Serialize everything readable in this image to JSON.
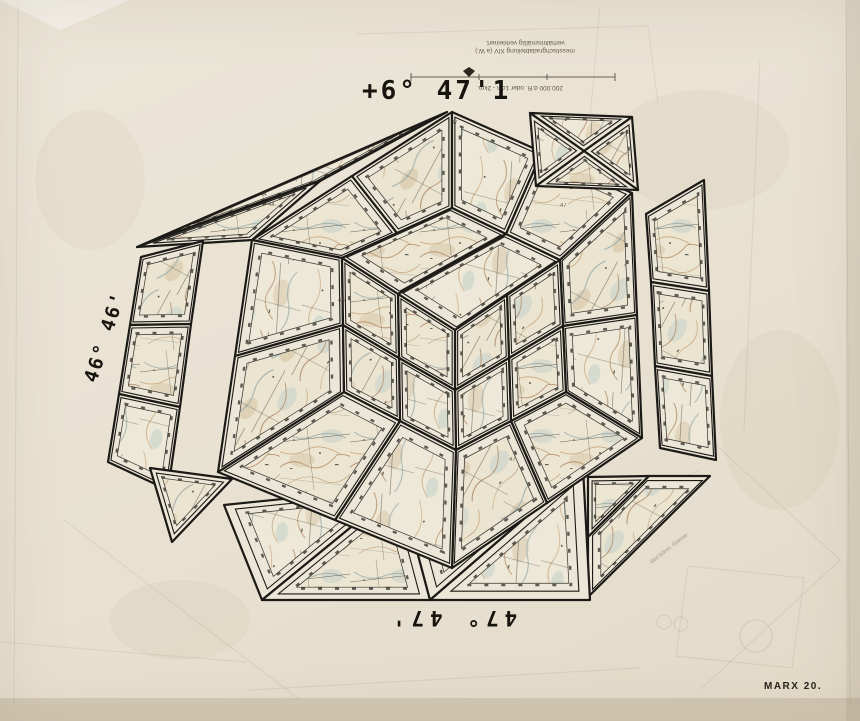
{
  "artwork": {
    "labels": {
      "top_big": "+6° 47'1",
      "left_coord": "46° 46'",
      "bottom_coord": "47° 47'",
      "signature": "MARX 20.",
      "pencil_note": "Süd böhm. Grenze"
    },
    "legend": {
      "line1": "messtischgradabteilung XIV (a W.)",
      "line2": "verhältnismäßig verkleinert.",
      "scale_caption": "200.000 d.R. oder 1cm - 2km."
    },
    "colors": {
      "paper": "#e8e1d2",
      "panel_margin": "#ebe6d7",
      "map_base": "#ece5d2",
      "contour_brown": "#b9926f",
      "water_blue": "#9fb0ad",
      "road_dark": "#4a4238",
      "outline_black": "#1c1a17"
    },
    "margin_numbers": [
      {
        "t": "44",
        "x": 260,
        "y": 196
      },
      {
        "t": "44",
        "x": 268,
        "y": 206
      },
      {
        "t": "47",
        "x": 451,
        "y": 124
      },
      {
        "t": "47",
        "x": 509,
        "y": 461
      },
      {
        "t": "47",
        "x": 560,
        "y": 207
      },
      {
        "t": "46",
        "x": 338,
        "y": 302
      }
    ],
    "panels": [
      {
        "id": "flap-topleft-a",
        "pts": [
          [
            137,
            247
          ],
          [
            447,
            112
          ],
          [
            320,
            181
          ]
        ],
        "tex": "m2",
        "k": 0.66
      },
      {
        "id": "flap-topleft-b",
        "pts": [
          [
            137,
            247
          ],
          [
            320,
            181
          ],
          [
            252,
            240
          ]
        ],
        "tex": "m1",
        "k": 0.66
      },
      {
        "id": "flap-left-1",
        "pts": [
          [
            141,
            257
          ],
          [
            203,
            241
          ],
          [
            191,
            324
          ],
          [
            130,
            325
          ]
        ],
        "tex": "m3",
        "k": 0.74
      },
      {
        "id": "flap-left-2",
        "pts": [
          [
            130,
            325
          ],
          [
            191,
            324
          ],
          [
            180,
            407
          ],
          [
            119,
            394
          ]
        ],
        "tex": "m1",
        "k": 0.74
      },
      {
        "id": "flap-left-3",
        "pts": [
          [
            119,
            394
          ],
          [
            180,
            407
          ],
          [
            168,
            490
          ],
          [
            108,
            462
          ]
        ],
        "tex": "m2",
        "k": 0.74
      },
      {
        "id": "flap-left-4",
        "pts": [
          [
            150,
            468
          ],
          [
            232,
            479
          ],
          [
            172,
            542
          ]
        ],
        "tex": "m3",
        "k": 0.64
      },
      {
        "id": "flap-right-1",
        "pts": [
          [
            646,
            214
          ],
          [
            704,
            180
          ],
          [
            709,
            291
          ],
          [
            651,
            282
          ]
        ],
        "tex": "m1",
        "k": 0.74
      },
      {
        "id": "flap-right-2",
        "pts": [
          [
            651,
            282
          ],
          [
            709,
            291
          ],
          [
            712,
            376
          ],
          [
            655,
            366
          ]
        ],
        "tex": "m3",
        "k": 0.74
      },
      {
        "id": "flap-right-3",
        "pts": [
          [
            655,
            366
          ],
          [
            712,
            376
          ],
          [
            716,
            460
          ],
          [
            660,
            448
          ]
        ],
        "tex": "m2",
        "k": 0.74
      },
      {
        "id": "flap-botright-a",
        "pts": [
          [
            588,
            477
          ],
          [
            649,
            476
          ],
          [
            588,
            537
          ]
        ],
        "tex": "m1",
        "k": 0.62
      },
      {
        "id": "flap-botright-b",
        "pts": [
          [
            649,
            476
          ],
          [
            710,
            476
          ],
          [
            588,
            597
          ],
          [
            588,
            537
          ]
        ],
        "tex": "m3",
        "k": 0.72
      },
      {
        "id": "flap-bottom-1",
        "pts": [
          [
            224,
            505
          ],
          [
            400,
            487
          ],
          [
            262,
            600
          ]
        ],
        "tex": "m2",
        "k": 0.66
      },
      {
        "id": "flap-bottom-2",
        "pts": [
          [
            400,
            487
          ],
          [
            430,
            600
          ],
          [
            262,
            600
          ]
        ],
        "tex": "m1",
        "k": 0.66
      },
      {
        "id": "flap-bottom-3",
        "pts": [
          [
            400,
            487
          ],
          [
            583,
            468
          ],
          [
            430,
            600
          ]
        ],
        "tex": "m3",
        "k": 0.66
      },
      {
        "id": "flap-bottom-4",
        "pts": [
          [
            583,
            468
          ],
          [
            590,
            600
          ],
          [
            430,
            600
          ]
        ],
        "tex": "m2",
        "k": 0.62
      },
      {
        "id": "top-band-1",
        "pts": [
          [
            252,
            240
          ],
          [
            352,
            176
          ],
          [
            397,
            233
          ],
          [
            342,
            258
          ]
        ],
        "tex": "m1",
        "k": 0.74
      },
      {
        "id": "top-band-2",
        "pts": [
          [
            352,
            176
          ],
          [
            452,
            112
          ],
          [
            452,
            208
          ],
          [
            397,
            233
          ]
        ],
        "tex": "m3",
        "k": 0.74
      },
      {
        "id": "top-band-3",
        "pts": [
          [
            452,
            112
          ],
          [
            542,
            152
          ],
          [
            506,
            234
          ],
          [
            452,
            208
          ]
        ],
        "tex": "m2",
        "k": 0.74
      },
      {
        "id": "top-band-4",
        "pts": [
          [
            542,
            152
          ],
          [
            632,
            193
          ],
          [
            560,
            260
          ],
          [
            506,
            234
          ]
        ],
        "tex": "m1",
        "k": 0.74
      },
      {
        "id": "right-band-1",
        "pts": [
          [
            632,
            193
          ],
          [
            637,
            315
          ],
          [
            563,
            326
          ],
          [
            560,
            260
          ]
        ],
        "tex": "m3",
        "k": 0.76
      },
      {
        "id": "right-band-2",
        "pts": [
          [
            637,
            315
          ],
          [
            642,
            438
          ],
          [
            566,
            392
          ],
          [
            563,
            326
          ]
        ],
        "tex": "m2",
        "k": 0.76
      },
      {
        "id": "right-band-3",
        "pts": [
          [
            642,
            438
          ],
          [
            547,
            503
          ],
          [
            511,
            421
          ],
          [
            566,
            392
          ]
        ],
        "tex": "m1",
        "k": 0.76
      },
      {
        "id": "right-band-4",
        "pts": [
          [
            547,
            503
          ],
          [
            452,
            568
          ],
          [
            456,
            450
          ],
          [
            511,
            421
          ]
        ],
        "tex": "m3",
        "k": 0.76
      },
      {
        "id": "left-band-1",
        "pts": [
          [
            452,
            568
          ],
          [
            335,
            520
          ],
          [
            400,
            421
          ],
          [
            456,
            450
          ]
        ],
        "tex": "m2",
        "k": 0.76
      },
      {
        "id": "left-band-2",
        "pts": [
          [
            335,
            520
          ],
          [
            218,
            472
          ],
          [
            344,
            392
          ],
          [
            400,
            421
          ]
        ],
        "tex": "m1",
        "k": 0.76
      },
      {
        "id": "left-band-3",
        "pts": [
          [
            218,
            472
          ],
          [
            235,
            356
          ],
          [
            343,
            325
          ],
          [
            344,
            392
          ]
        ],
        "tex": "m3",
        "k": 0.76
      },
      {
        "id": "left-band-4",
        "pts": [
          [
            235,
            356
          ],
          [
            252,
            240
          ],
          [
            342,
            258
          ],
          [
            343,
            325
          ]
        ],
        "tex": "m2",
        "k": 0.76
      },
      {
        "id": "inner-top-1",
        "pts": [
          [
            452,
            208
          ],
          [
            506,
            234
          ],
          [
            398,
            294
          ],
          [
            342,
            258
          ]
        ],
        "tex": "m1",
        "k": 0.76
      },
      {
        "id": "inner-top-2",
        "pts": [
          [
            506,
            234
          ],
          [
            560,
            260
          ],
          [
            455,
            330
          ],
          [
            398,
            294
          ]
        ],
        "tex": "m2",
        "k": 0.76
      },
      {
        "id": "inner-right-1",
        "pts": [
          [
            560,
            260
          ],
          [
            563,
            326
          ],
          [
            509,
            358
          ],
          [
            507,
            295
          ]
        ],
        "tex": "m3",
        "k": 0.72
      },
      {
        "id": "inner-right-2",
        "pts": [
          [
            563,
            326
          ],
          [
            566,
            392
          ],
          [
            511,
            421
          ],
          [
            509,
            358
          ]
        ],
        "tex": "m1",
        "k": 0.72
      },
      {
        "id": "inner-right-3",
        "pts": [
          [
            509,
            358
          ],
          [
            511,
            421
          ],
          [
            456,
            450
          ],
          [
            455,
            390
          ]
        ],
        "tex": "m2",
        "k": 0.72
      },
      {
        "id": "inner-right-4",
        "pts": [
          [
            507,
            295
          ],
          [
            509,
            358
          ],
          [
            455,
            390
          ],
          [
            455,
            330
          ]
        ],
        "tex": "m3",
        "k": 0.72
      },
      {
        "id": "inner-left-1",
        "pts": [
          [
            455,
            330
          ],
          [
            455,
            390
          ],
          [
            399,
            358
          ],
          [
            398,
            294
          ]
        ],
        "tex": "m1",
        "k": 0.72
      },
      {
        "id": "inner-left-2",
        "pts": [
          [
            455,
            390
          ],
          [
            456,
            450
          ],
          [
            400,
            421
          ],
          [
            399,
            358
          ]
        ],
        "tex": "m2",
        "k": 0.72
      },
      {
        "id": "inner-left-3",
        "pts": [
          [
            399,
            358
          ],
          [
            400,
            421
          ],
          [
            344,
            392
          ],
          [
            343,
            325
          ]
        ],
        "tex": "m3",
        "k": 0.72
      },
      {
        "id": "inner-left-4",
        "pts": [
          [
            398,
            294
          ],
          [
            399,
            358
          ],
          [
            343,
            325
          ],
          [
            342,
            258
          ]
        ],
        "tex": "m1",
        "k": 0.72
      },
      {
        "id": "corner-x-1",
        "pts": [
          [
            530,
            113
          ],
          [
            632,
            117
          ],
          [
            584,
            151
          ]
        ],
        "tex": "m2",
        "k": 0.6
      },
      {
        "id": "corner-x-2",
        "pts": [
          [
            632,
            117
          ],
          [
            638,
            190
          ],
          [
            584,
            151
          ]
        ],
        "tex": "m3",
        "k": 0.6
      },
      {
        "id": "corner-x-3",
        "pts": [
          [
            638,
            190
          ],
          [
            536,
            186
          ],
          [
            584,
            151
          ]
        ],
        "tex": "m1",
        "k": 0.6
      },
      {
        "id": "corner-x-4",
        "pts": [
          [
            536,
            186
          ],
          [
            530,
            113
          ],
          [
            584,
            151
          ]
        ],
        "tex": "m2",
        "k": 0.6
      }
    ]
  }
}
